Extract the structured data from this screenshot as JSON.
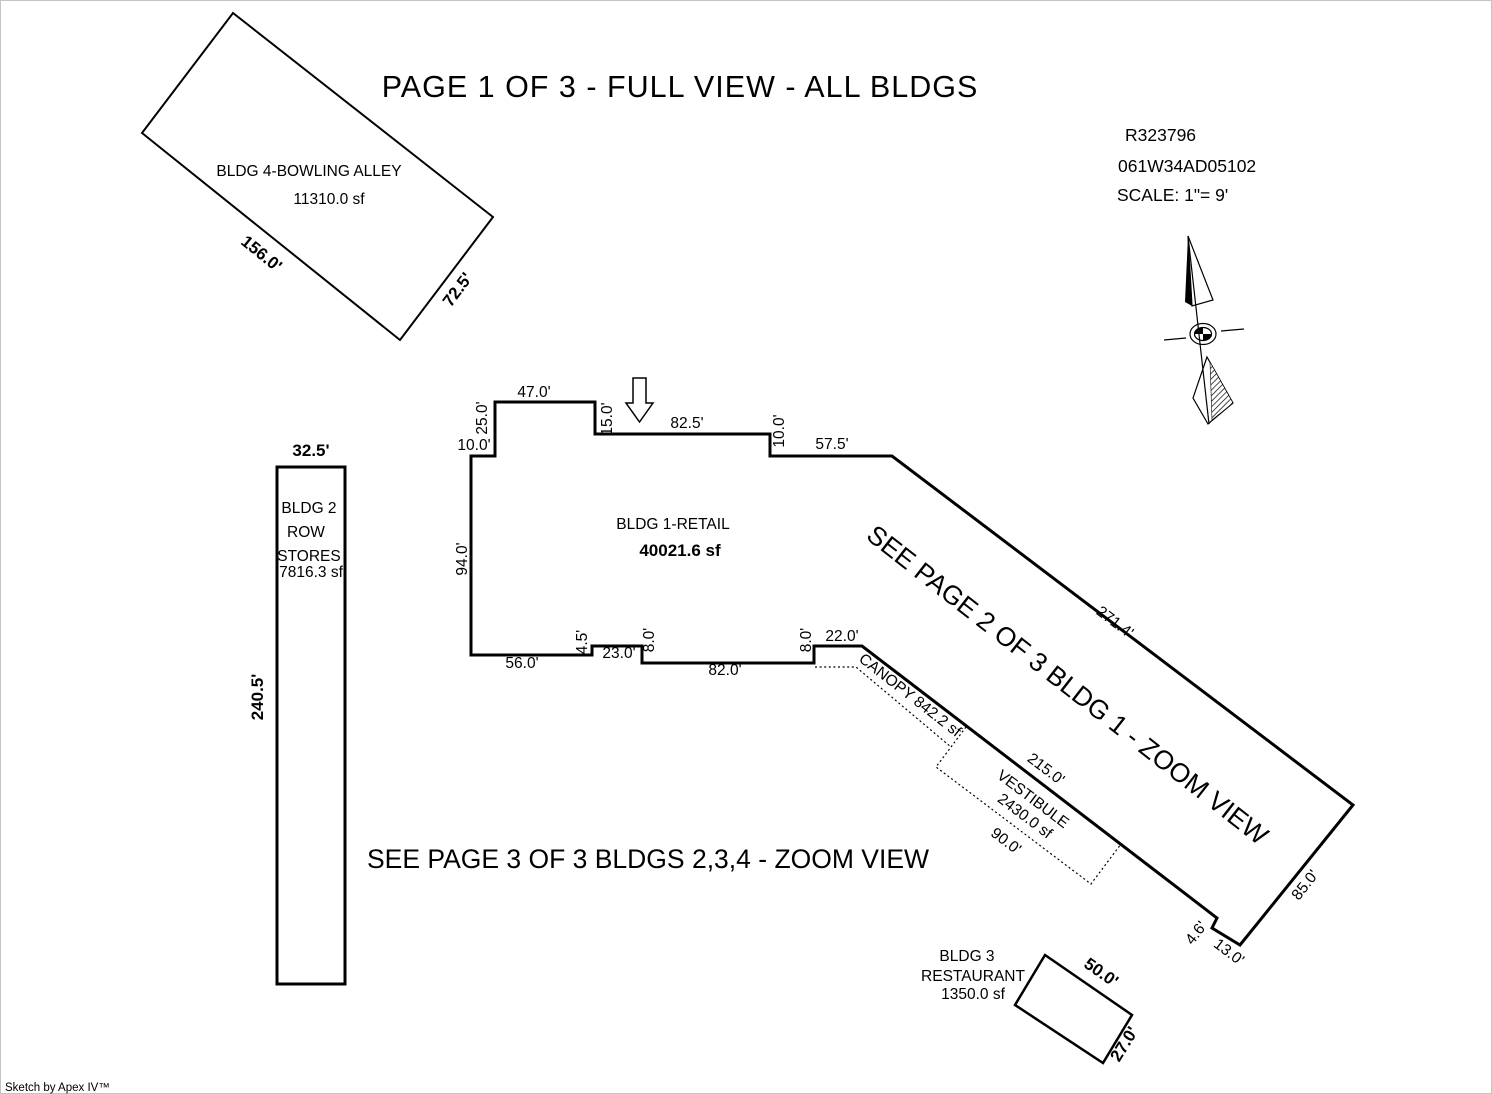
{
  "page": {
    "title": "PAGE 1 OF 3 - FULL VIEW - ALL BLDGS",
    "note_bldg1": "SEE PAGE 2 OF 3 BLDG 1 - ZOOM VIEW",
    "note_bldgs234": "SEE PAGE 3 OF 3 BLDGS 2,3,4 - ZOOM VIEW",
    "credit": "Sketch by Apex IV™"
  },
  "header": {
    "record_number": "R323796",
    "parcel_number": "061W34AD05102",
    "scale": "SCALE: 1\"= 9'"
  },
  "bldg1": {
    "name": "BLDG 1-RETAIL",
    "area": "40021.6 sf",
    "dims": {
      "top_notch_width": "47.0'",
      "top_notch_left": "25.0'",
      "top_step_left": "10.0'",
      "top_notch_right": "15.0'",
      "top_mid": "82.5'",
      "top_step_right": "10.0'",
      "top_right": "57.5'",
      "left": "94.0'",
      "ne_diagonal": "271.4'",
      "se_side": "85.0'",
      "notch_a": "4.6'",
      "notch_b": "13.0'",
      "bottom_right": "22.0'",
      "bottom_step_right": "8.0'",
      "bottom_mid": "82.0'",
      "bottom_step_mid": "8.0'",
      "bottom_mid_left": "23.0'",
      "bottom_step_left": "4.5'",
      "bottom_left": "56.0'",
      "sw_diagonal": "215.0'"
    }
  },
  "canopy": {
    "label": "CANOPY 842.2 sf"
  },
  "vestibule": {
    "name": "VESTIBULE",
    "area": "2430.0 sf",
    "width": "90.0'"
  },
  "bldg2": {
    "name1": "BLDG 2",
    "name2": "ROW",
    "name3": "STORES",
    "area": "7816.3 sf",
    "width": "32.5'",
    "length": "240.5'"
  },
  "bldg3": {
    "name1": "BLDG 3",
    "name2": "RESTAURANT",
    "area": "1350.0 sf",
    "length": "50.0'",
    "width": "27.0'"
  },
  "bldg4": {
    "name": "BLDG 4-BOWLING ALLEY",
    "area": "11310.0 sf",
    "length": "156.0'",
    "width": "72.5'"
  }
}
